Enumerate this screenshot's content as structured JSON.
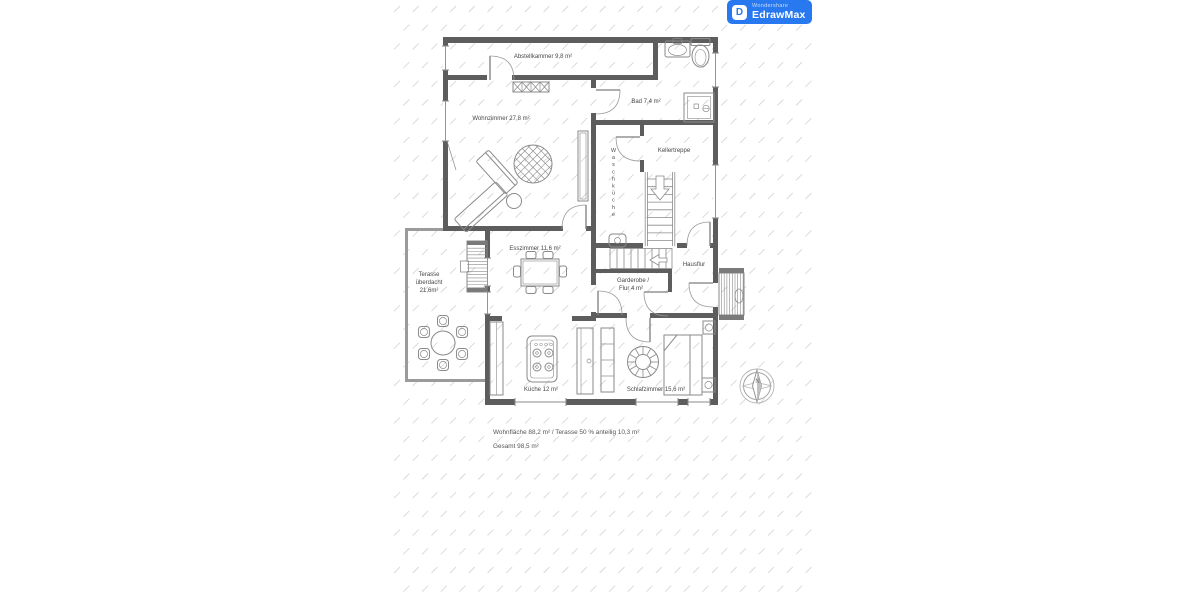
{
  "app": {
    "brand_small": "Wondershare",
    "brand": "EdrawMax",
    "logo_glyph": "D",
    "badge_color": "#2878f0"
  },
  "plan": {
    "rooms": {
      "abstellkammer": {
        "label": "Abstellkammer 9,8 m²"
      },
      "wohnzimmer": {
        "label": "Wohnzimmer 27,8 m²"
      },
      "bad": {
        "label": "Bad 7,4 m²"
      },
      "kellertreppe": {
        "label": "Kellertreppe"
      },
      "waschkueche": {
        "label": "Waschküche"
      },
      "esszimmer": {
        "label": "Esszimmer 11,6 m²"
      },
      "terasse": {
        "line1": "Terasse",
        "line2": "überdacht",
        "line3": "21,6m²"
      },
      "hausflur": {
        "label": "Hausflur"
      },
      "garderobe": {
        "line1": "Garderobe /",
        "line2": "Flur 4 m²"
      },
      "kueche": {
        "label": "Küche 12 m²"
      },
      "schlafzimmer": {
        "label": "Schlafzimmer 15,6 m²"
      }
    },
    "summary": {
      "line1": "Wohnfläche 88,2 m² / Terasse 50 % anteilig 10,3 m²",
      "line2": "Gesamt 98,5 m²"
    },
    "compass": {
      "north_label": "N"
    },
    "colors": {
      "wall": "#5d5d5d",
      "terrace_wall": "#9b9b9b",
      "line": "#8a8a8a",
      "hatch": "#d8d8d8",
      "text": "#474747"
    }
  }
}
